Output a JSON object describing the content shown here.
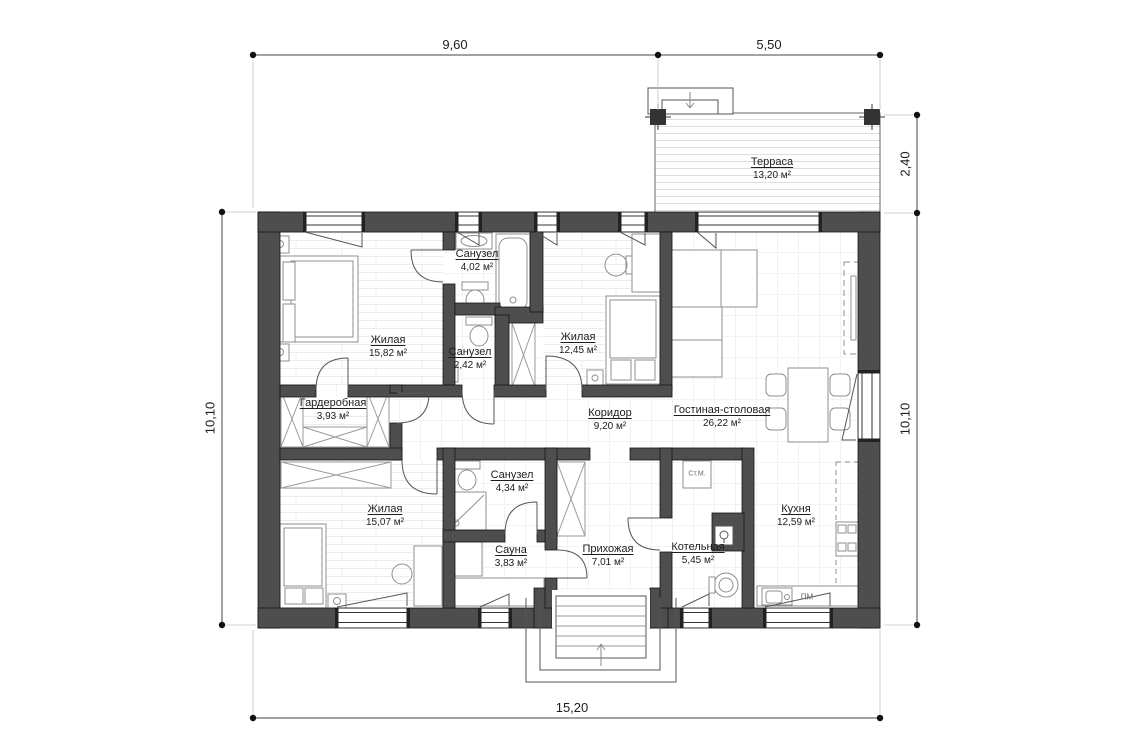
{
  "dimensions": {
    "top_left": "9,60",
    "top_right": "5,50",
    "bottom": "15,20",
    "left": "10,10",
    "right_upper": "2,40",
    "right_lower": "10,10"
  },
  "rooms": [
    {
      "id": "terrace",
      "name": "Терраса",
      "area": "13,20 м²"
    },
    {
      "id": "bedroom-1",
      "name": "Жилая",
      "area": "15,82 м²"
    },
    {
      "id": "wc-1",
      "name": "Санузел",
      "area": "4,02 м²"
    },
    {
      "id": "wc-2",
      "name": "Санузел",
      "area": "2,42 м²"
    },
    {
      "id": "bedroom-2",
      "name": "Жилая",
      "area": "12,45 м²"
    },
    {
      "id": "living",
      "name": "Гостиная-столовая",
      "area": "26,22 м²"
    },
    {
      "id": "wardrobe",
      "name": "Гардеробная",
      "area": "3,93 м²"
    },
    {
      "id": "corridor",
      "name": "Коридор",
      "area": "9,20 м²"
    },
    {
      "id": "bedroom-3",
      "name": "Жилая",
      "area": "15,07 м²"
    },
    {
      "id": "wc-3",
      "name": "Санузел",
      "area": "4,34 м²"
    },
    {
      "id": "sauna",
      "name": "Сауна",
      "area": "3,83 м²"
    },
    {
      "id": "hallway",
      "name": "Прихожая",
      "area": "7,01 м²"
    },
    {
      "id": "boiler",
      "name": "Котельная",
      "area": "5,45 м²"
    },
    {
      "id": "kitchen",
      "name": "Кухня",
      "area": "12,59 м²"
    }
  ],
  "appliances": {
    "washing_machine": "Ст.М.",
    "dishwasher": "ПМ"
  },
  "colors": {
    "wall": "#4e4e4e",
    "line": "#444444",
    "text": "#1d1d1d"
  }
}
